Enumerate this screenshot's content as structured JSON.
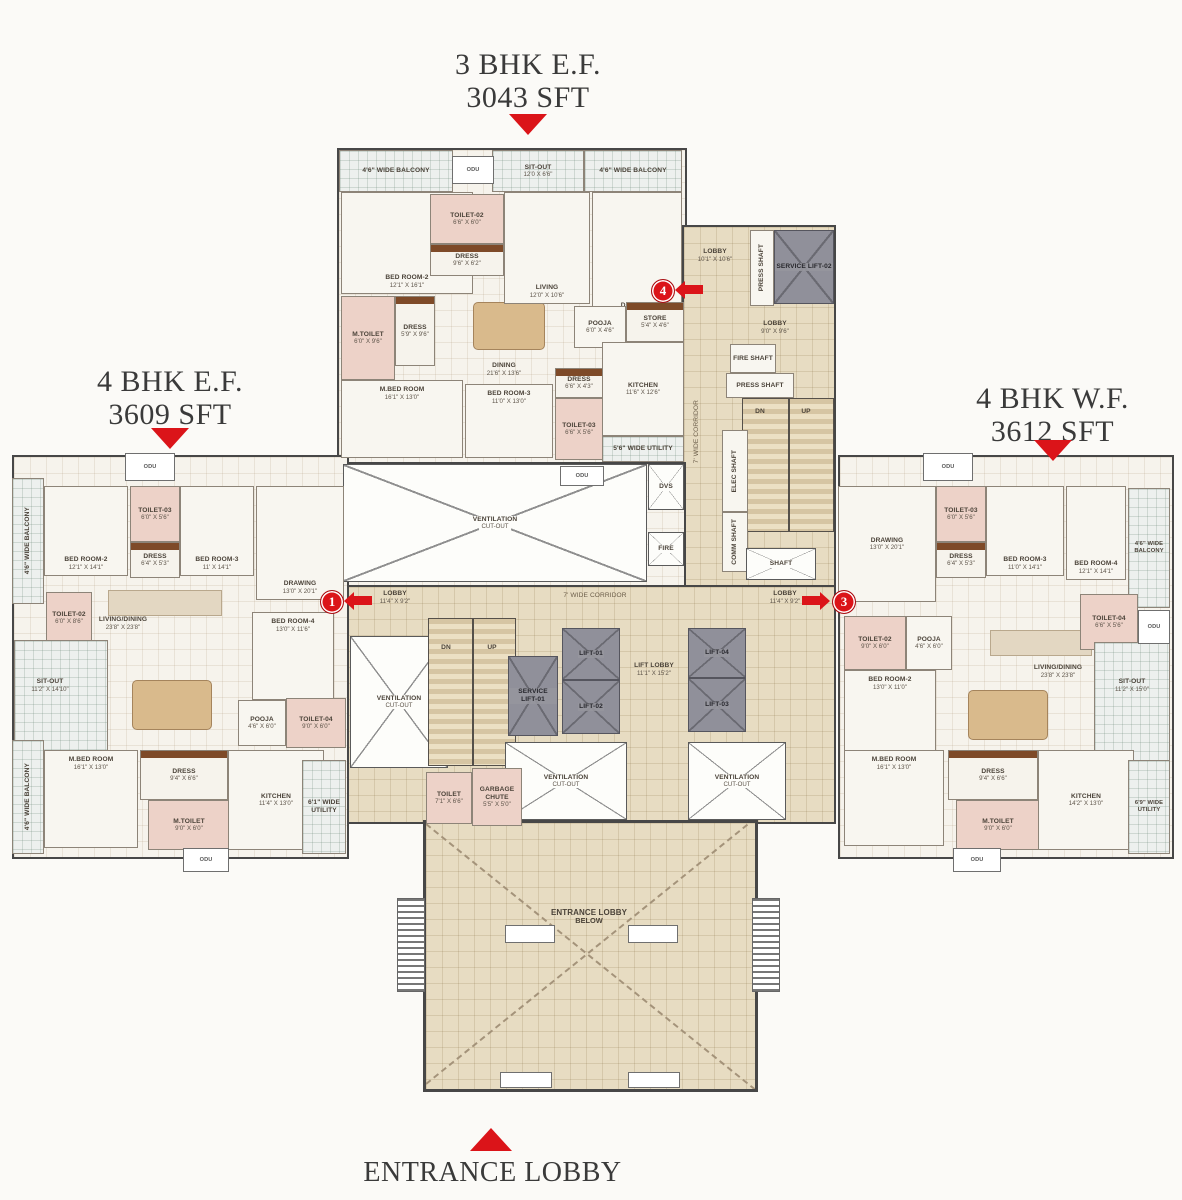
{
  "titles": {
    "top": {
      "line1": "3 BHK E.F.",
      "line2": "3043 SFT"
    },
    "left": {
      "line1": "4 BHK E.F.",
      "line2": "3609 SFT"
    },
    "right": {
      "line1": "4 BHK W.F.",
      "line2": "3612 SFT"
    },
    "bottom": "ENTRANCE LOBBY"
  },
  "markers": {
    "m1": "1",
    "m3": "3",
    "m4": "4"
  },
  "colors": {
    "accent_red": "#db1419",
    "corridor_tan": "#e7dcc2",
    "toilet_pink": "#edd2c8",
    "lift_grey": "#90909a"
  },
  "top_unit": {
    "rooms": [
      {
        "name": "4'6\" WIDE BALCONY",
        "dims": ""
      },
      {
        "name": "SIT-OUT",
        "dims": "12'0 X 6'6\""
      },
      {
        "name": "4'6\" WIDE BALCONY",
        "dims": ""
      },
      {
        "name": "ODU",
        "dims": ""
      },
      {
        "name": "BED ROOM-2",
        "dims": "12'1\" X 16'1\""
      },
      {
        "name": "TOILET-02",
        "dims": "6'6\" X 6'0\""
      },
      {
        "name": "DRESS",
        "dims": "9'6\" X 6'2\""
      },
      {
        "name": "LIVING",
        "dims": "12'0\" X 10'6\""
      },
      {
        "name": "DRAWING",
        "dims": "13'0\" X 16'1\""
      },
      {
        "name": "M.TOILET",
        "dims": "6'0\" X 9'6\""
      },
      {
        "name": "DRESS",
        "dims": "5'9\" X 9'6\""
      },
      {
        "name": "DINING",
        "dims": "21'6\" X 13'6\""
      },
      {
        "name": "POOJA",
        "dims": "6'0\" X 4'6\""
      },
      {
        "name": "STORE",
        "dims": "5'4\" X 4'6\""
      },
      {
        "name": "KITCHEN",
        "dims": "11'6\" X 12'6\""
      },
      {
        "name": "M.BED ROOM",
        "dims": "16'1\" X 13'0\""
      },
      {
        "name": "BED ROOM-3",
        "dims": "11'0\" X 13'0\""
      },
      {
        "name": "DRESS",
        "dims": "6'6\" X 4'3\""
      },
      {
        "name": "TOILET-03",
        "dims": "6'6\" X 5'6\""
      },
      {
        "name": "5'6\" WIDE UTILITY",
        "dims": ""
      }
    ]
  },
  "core": {
    "rooms": [
      {
        "name": "LOBBY",
        "dims": "10'1\" X 10'6\""
      },
      {
        "name": "PRESS SHAFT",
        "dims": ""
      },
      {
        "name": "SERVICE LIFT-02",
        "dims": ""
      },
      {
        "name": "LOBBY",
        "dims": "9'0\" X 9'6\""
      },
      {
        "name": "FIRE SHAFT",
        "dims": ""
      },
      {
        "name": "PRESS SHAFT",
        "dims": ""
      },
      {
        "name": "DN",
        "dims": ""
      },
      {
        "name": "UP",
        "dims": ""
      },
      {
        "name": "ELEC SHAFT",
        "dims": ""
      },
      {
        "name": "COMM SHAFT",
        "dims": ""
      },
      {
        "name": "SHAFT",
        "dims": ""
      },
      {
        "name": "7' WIDE CORRIDOR",
        "dims": ""
      },
      {
        "name": "VENTILATION",
        "dims": "CUT-OUT"
      },
      {
        "name": "ODU",
        "dims": ""
      },
      {
        "name": "DVS",
        "dims": ""
      },
      {
        "name": "FIRE",
        "dims": ""
      },
      {
        "name": "7' WIDE CORRIDOR",
        "dims": ""
      },
      {
        "name": "LOBBY",
        "dims": "11'4\" X 9'2\""
      },
      {
        "name": "LOBBY",
        "dims": "11'4\" X 9'2\""
      },
      {
        "name": "VENTILATION",
        "dims": "CUT-OUT"
      },
      {
        "name": "DN",
        "dims": ""
      },
      {
        "name": "UP",
        "dims": ""
      },
      {
        "name": "SERVICE LIFT-01",
        "dims": ""
      },
      {
        "name": "LIFT-01",
        "dims": ""
      },
      {
        "name": "LIFT-02",
        "dims": ""
      },
      {
        "name": "LIFT LOBBY",
        "dims": "11'1\" X 15'2\""
      },
      {
        "name": "LIFT-04",
        "dims": ""
      },
      {
        "name": "LIFT-03",
        "dims": ""
      },
      {
        "name": "VENTILATION",
        "dims": "CUT-OUT"
      },
      {
        "name": "VENTILATION",
        "dims": "CUT-OUT"
      },
      {
        "name": "TOILET",
        "dims": "7'1\" X 6'6\""
      },
      {
        "name": "GARBAGE CHUTE",
        "dims": "5'5\" X 5'0\""
      },
      {
        "name": "ENTRANCE LOBBY",
        "dims": "BELOW"
      }
    ]
  },
  "left_unit": {
    "rooms": [
      {
        "name": "ODU",
        "dims": ""
      },
      {
        "name": "4'6\" WIDE BALCONY",
        "dims": ""
      },
      {
        "name": "BED ROOM-2",
        "dims": "12'1\" X 14'1\""
      },
      {
        "name": "TOILET-03",
        "dims": "6'0\" X 5'6\""
      },
      {
        "name": "DRESS",
        "dims": "6'4\" X 5'3\""
      },
      {
        "name": "BED ROOM-3",
        "dims": "11' X 14'1\""
      },
      {
        "name": "DRAWING",
        "dims": "13'0\" X 20'1\""
      },
      {
        "name": "TOILET-02",
        "dims": "6'0\" X 8'6\""
      },
      {
        "name": "LIVING/DINING",
        "dims": "23'8\" X 23'8\""
      },
      {
        "name": "SIT-OUT",
        "dims": "11'2\" X 14'10\""
      },
      {
        "name": "BED ROOM-4",
        "dims": "13'0\" X 11'6\""
      },
      {
        "name": "POOJA",
        "dims": "4'6\" X 6'0\""
      },
      {
        "name": "TOILET-04",
        "dims": "9'0\" X 6'0\""
      },
      {
        "name": "4'6\" WIDE BALCONY",
        "dims": ""
      },
      {
        "name": "M.BED ROOM",
        "dims": "16'1\" X 13'0\""
      },
      {
        "name": "DRESS",
        "dims": "9'4\" X 6'6\""
      },
      {
        "name": "M.TOILET",
        "dims": "9'0\" X 6'0\""
      },
      {
        "name": "KITCHEN",
        "dims": "11'4\" X 13'0\""
      },
      {
        "name": "6'1\" WIDE UTILITY",
        "dims": ""
      },
      {
        "name": "ODU",
        "dims": ""
      }
    ]
  },
  "right_unit": {
    "rooms": [
      {
        "name": "ODU",
        "dims": ""
      },
      {
        "name": "DRAWING",
        "dims": "13'0\" X 20'1\""
      },
      {
        "name": "TOILET-03",
        "dims": "6'0\" X 5'6\""
      },
      {
        "name": "DRESS",
        "dims": "6'4\" X 5'3\""
      },
      {
        "name": "BED ROOM-3",
        "dims": "11'0\" X 14'1\""
      },
      {
        "name": "BED ROOM-4",
        "dims": "12'1\" X 14'1\""
      },
      {
        "name": "4'6\" WIDE BALCONY",
        "dims": ""
      },
      {
        "name": "TOILET-04",
        "dims": "6'6\" X 5'6\""
      },
      {
        "name": "ODU",
        "dims": ""
      },
      {
        "name": "TOILET-02",
        "dims": "9'0\" X 6'0\""
      },
      {
        "name": "POOJA",
        "dims": "4'6\" X 6'0\""
      },
      {
        "name": "BED ROOM-2",
        "dims": "13'0\" X 11'0\""
      },
      {
        "name": "LIVING/DINING",
        "dims": "23'8\" X 23'8\""
      },
      {
        "name": "SIT-OUT",
        "dims": "11'2\" X 15'0\""
      },
      {
        "name": "M.BED ROOM",
        "dims": "16'1\" X 13'0\""
      },
      {
        "name": "DRESS",
        "dims": "9'4\" X 6'6\""
      },
      {
        "name": "M.TOILET",
        "dims": "9'0\" X 6'0\""
      },
      {
        "name": "KITCHEN",
        "dims": "14'2\" X 13'0\""
      },
      {
        "name": "6'9\" WIDE UTILITY",
        "dims": ""
      },
      {
        "name": "ODU",
        "dims": ""
      }
    ]
  }
}
